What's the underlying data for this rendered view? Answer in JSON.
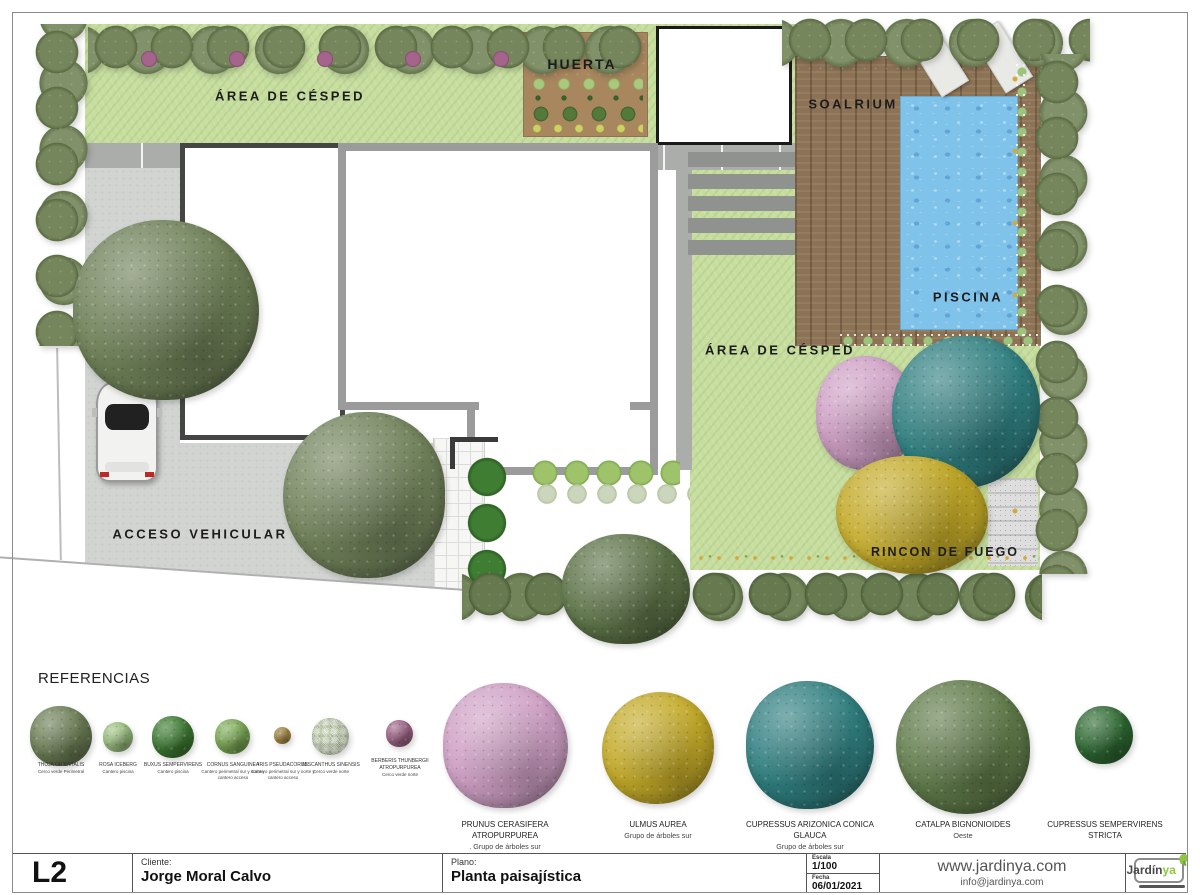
{
  "plan": {
    "labels": {
      "lawn_top": "ÁREA DE CÉSPED",
      "huerta": "HUERTA",
      "soalrium": "SOALRIUM",
      "piscina": "PISCINA",
      "lawn_east": "ÁREA DE CÉSPED",
      "acceso_vehicular": "ACCESO VEHICULAR",
      "rincon_de_fuego": "RINCON DE FUEGO"
    },
    "colors": {
      "lawn": "#c6dd9e",
      "driveway": "#d2d4d1",
      "deck_wood": "#8d7355",
      "pool_water": "#7fc2ea",
      "huerta_soil": "#a8875f",
      "hedge_olive": "#72835b",
      "tree_teal": "#2f7e7f",
      "tree_yellow": "#c3aa28",
      "tree_pink": "#cfa0c5"
    }
  },
  "references": {
    "title": "REFERENCIAS",
    "small_items": [
      {
        "name": "THUJA ORIENTALIS",
        "location": "Cerco verde Perimetral",
        "color": "#6d7f56"
      },
      {
        "name": "ROSA ICEBERG",
        "location": "Cantero piscina",
        "color": "#a3c887"
      },
      {
        "name": "BUXUS SEMPERVIRENS",
        "location": "Cantero piscina",
        "color": "#3f7d33"
      },
      {
        "name": "CORNUS SANGUINEA",
        "location": "Cantero perimetral sur y norte y cantero acceso",
        "color": "#7fae58"
      },
      {
        "name": "IRIS PSEUDACORUS",
        "location": "Cantero perimetral sur y norte y cantero acceso",
        "color": "#b99a4e"
      },
      {
        "name": "MISCANTHUS SINENSIS",
        "location": "Cerco verde norte",
        "color": "#ccd6bd"
      },
      {
        "name": "BERBERIS THUNBERGII ATROPURPUREA",
        "location": "Cerco verde norte",
        "color": "#a66a8e"
      }
    ],
    "large_items": [
      {
        "name": "PRUNUS CERASIFERA ATROPURPUREA",
        "location": ". Grupo de árboles sur",
        "color": "#cfa0c5"
      },
      {
        "name": "ULMUS AUREA",
        "location": "Grupo de árboles sur",
        "color": "#c3aa28"
      },
      {
        "name": "CUPRESSUS ARIZONICA CONICA GLAUCA",
        "location": "Grupo de árboles sur",
        "color": "#2f7e7f"
      },
      {
        "name": "CATALPA BIGNONIOIDES",
        "location": "Oeste",
        "color": "#5f7a49"
      },
      {
        "name": "CUPRESSUS SEMPERVIRENS STRICTA",
        "location": "",
        "color": "#2f6b33"
      }
    ]
  },
  "titleblock": {
    "sheet_code": "L2",
    "client_label": "Cliente:",
    "client_name": "Jorge Moral Calvo",
    "plan_label": "Plano:",
    "plan_name": "Planta paisajística",
    "scale_label": "Escala",
    "scale_value": "1/100",
    "date_label": "Fecha",
    "date_value": "06/01/2021",
    "website": "www.jardinya.com",
    "email": "info@jardinya.com",
    "logo": {
      "part1": "Jardín",
      "part2": "ya"
    }
  }
}
